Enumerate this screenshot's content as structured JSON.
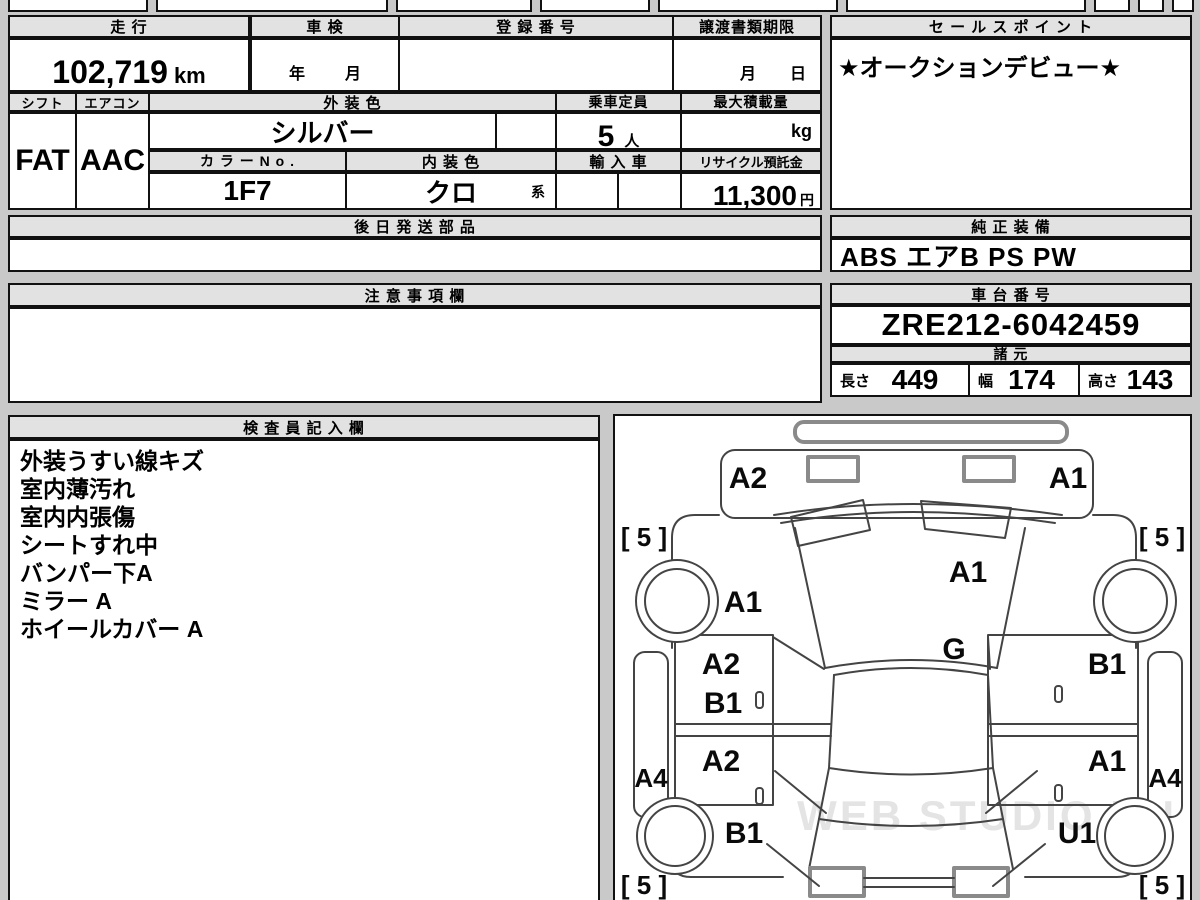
{
  "header_table": {
    "mileage": {
      "label": "走 行",
      "value": "102,719",
      "unit": "km"
    },
    "shaken": {
      "label": "車 検",
      "year_label": "年",
      "month_label": "月",
      "value": ""
    },
    "registration": {
      "label": "登 録 番 号",
      "value": ""
    },
    "transfer_deadline": {
      "label": "譲渡書類期限",
      "month_label": "月",
      "day_label": "日",
      "value": ""
    },
    "shift": {
      "label": "シフト",
      "value": "FAT"
    },
    "aircon": {
      "label": "エアコン",
      "value": "AAC"
    },
    "exterior_color": {
      "label": "外 装 色",
      "value": "シルバー"
    },
    "capacity": {
      "label": "乗車定員",
      "value": "5",
      "unit": "人"
    },
    "max_load": {
      "label": "最大積載量",
      "value": "",
      "unit": "kg"
    },
    "color_no": {
      "label": "カ ラ ー N o .",
      "value": "1F7"
    },
    "interior_color": {
      "label": "内 装 色",
      "value": "クロ",
      "suffix": "系"
    },
    "import_car": {
      "label": "輸 入 車",
      "value": ""
    },
    "recycle_deposit": {
      "label": "リサイクル預託金",
      "value": "11,300",
      "unit": "円"
    }
  },
  "sales_point": {
    "label": "セ ー ル ス ポ イ ン ト",
    "value": "★オークションデビュー★"
  },
  "later_parts": {
    "label": "後 日 発 送 部 品",
    "value": ""
  },
  "genuine_equipment": {
    "label": "純 正 装 備",
    "value": "ABS エアB PS PW"
  },
  "notes": {
    "label": "注 意 事 項 欄",
    "value": ""
  },
  "chassis": {
    "label": "車 台 番 号",
    "value": "ZRE212-6042459"
  },
  "specs": {
    "label": "諸 元",
    "length_label": "長さ",
    "length": "449",
    "width_label": "幅",
    "width": "174",
    "height_label": "高さ",
    "height": "143"
  },
  "inspector_notes": {
    "label": "検 査 員 記 入 欄",
    "lines": [
      "外装うすい線キズ",
      "室内薄汚れ",
      "室内内張傷",
      "シートすれ中",
      "バンパー下A",
      "ミラー A",
      "ホイールカバー A"
    ]
  },
  "diagram": {
    "watermark": "WEB STUDIO RU",
    "labels": {
      "front_bumper_left": "A2",
      "front_bumper_right": "A1",
      "tread_front_left": "[ 5 ]",
      "tread_front_right": "[ 5 ]",
      "fender_front_left": "A1",
      "windshield": "A1",
      "glass": "G",
      "door_front_left_upper": "A2",
      "door_front_left_lower": "B1",
      "door_front_right": "B1",
      "door_rear_left": "A2",
      "door_rear_right": "A1",
      "sill_left": "A4",
      "sill_right": "A4",
      "fender_rear_left": "B1",
      "fender_rear_right": "U1",
      "tread_rear_left": "[ 5 ]",
      "tread_rear_right": "[ 5 ]"
    }
  }
}
